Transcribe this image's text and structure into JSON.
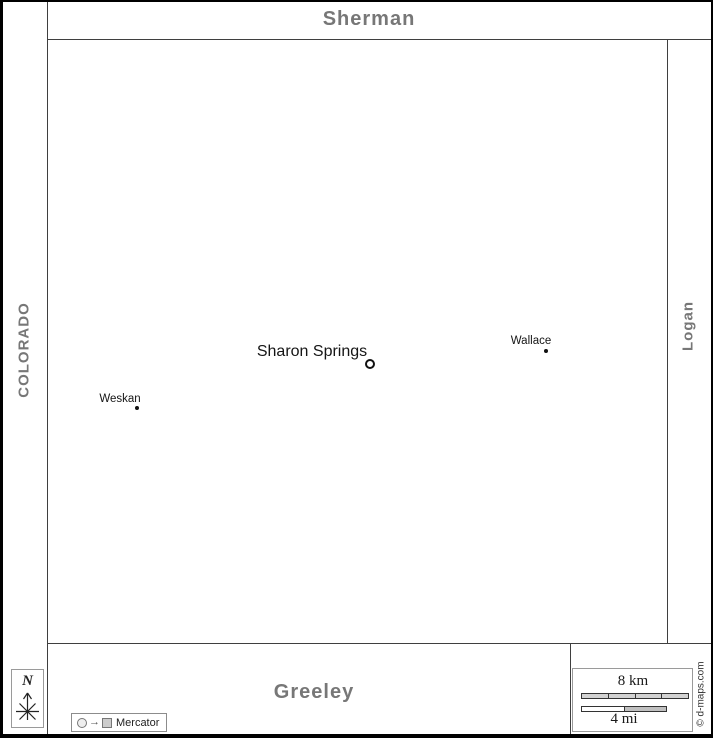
{
  "neighbors": {
    "north": "Sherman",
    "west": "COLORADO",
    "east": "Logan",
    "south": "Greeley"
  },
  "cities": [
    {
      "name": "Sharon Springs",
      "marker": "ring"
    },
    {
      "name": "Wallace",
      "marker": "dot"
    },
    {
      "name": "Weskan",
      "marker": "dot"
    }
  ],
  "compass": {
    "label": "N"
  },
  "legend": {
    "arrow_glyph": "→",
    "label": "Mercator"
  },
  "scale_bar": {
    "top_label": "8 km",
    "bottom_label": "4 mi",
    "km_segments": 4,
    "mi_segments": 2
  },
  "credit": "© d-maps.com",
  "colors": {
    "neighbor_label": "#777777",
    "border_line": "#3f3f3f",
    "frame": "#000000",
    "city_label": "#151515",
    "scale_fill": "#d2d2d2"
  }
}
